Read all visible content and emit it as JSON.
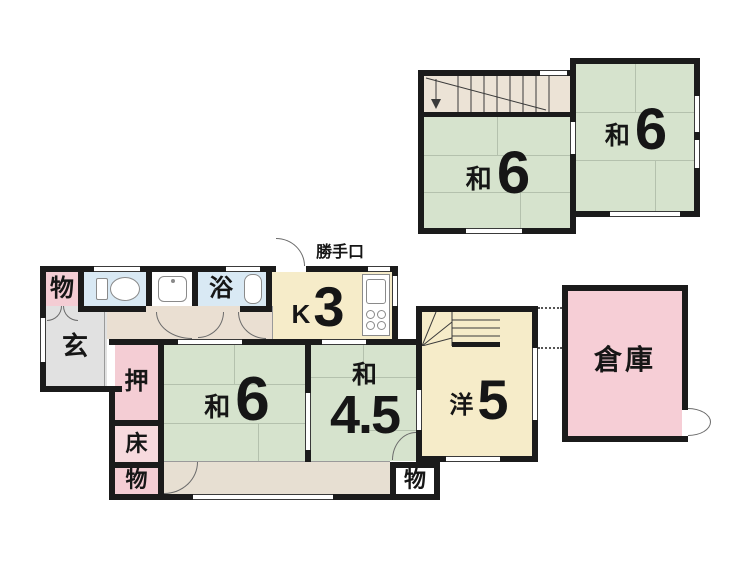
{
  "title": "floor-plan",
  "colors": {
    "wall": "#1b1b1b",
    "tatami_green": "#d6e3cd",
    "cream_yellow": "#f6ecc9",
    "pink": "#f4cdd4",
    "light_blue": "#d9e9f4",
    "entrance_gray": "#e1e1e1",
    "corridor_beige": "#eadfd2",
    "veranda_beige": "#e7dfd2",
    "stair_beige": "#ece3d6",
    "white": "#ffffff"
  },
  "first_floor": {
    "storage_top_left": {
      "label": "物"
    },
    "bath": {
      "label": "浴"
    },
    "kitchen": {
      "kanji": "K",
      "value": "3"
    },
    "back_door": {
      "label": "勝手口"
    },
    "entrance": {
      "label": "玄"
    },
    "closet_oshiire": {
      "label": "押"
    },
    "tokonoma": {
      "label": "床"
    },
    "storage_bottom_left": {
      "label": "物"
    },
    "japanese_room_6": {
      "kanji": "和",
      "value": "6"
    },
    "japanese_room_45": {
      "kanji": "和",
      "value": "4.5"
    },
    "western_room_5": {
      "kanji": "洋",
      "value": "5"
    },
    "storage_bottom_right": {
      "label": "物"
    },
    "warehouse": {
      "label": "倉庫"
    }
  },
  "second_floor": {
    "japanese_room_6_left": {
      "kanji": "和",
      "value": "6"
    },
    "japanese_room_6_right": {
      "kanji": "和",
      "value": "6"
    }
  },
  "icons": {
    "toilet": "toilet-icon",
    "washbasin": "washbasin-icon",
    "bathtub": "bathtub-icon",
    "kitchen_counter": "kitchen-counter-icon",
    "sink": "sink-icon",
    "stove": "stove-icon",
    "stairs_up": "staircase-icon",
    "stairs_down_arrow": "down-arrow-icon",
    "door_swing": "door-arc-icon"
  }
}
